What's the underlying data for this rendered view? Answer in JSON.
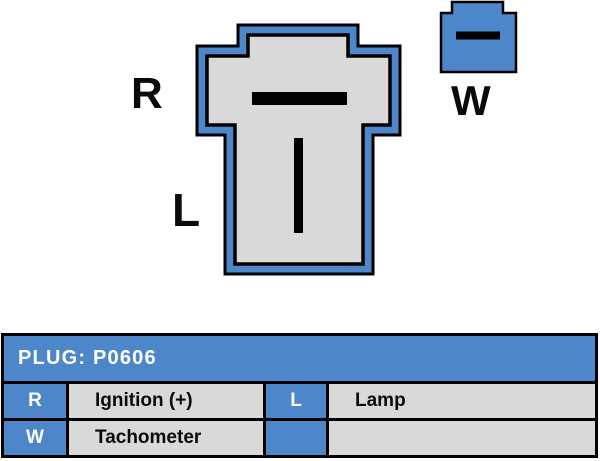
{
  "diagram": {
    "main_connector": {
      "terminal_r_label": "R",
      "terminal_l_label": "L"
    },
    "aux_connector": {
      "terminal_w_label": "W"
    },
    "colors": {
      "connector_blue": "#4d87c9",
      "connector_gray": "#d9d9d9",
      "outline_black": "#000000"
    }
  },
  "table": {
    "title": "PLUG: P0606",
    "header_bg": "#4d87c9",
    "rows": [
      {
        "key1": "R",
        "value1": "Ignition (+)",
        "key2": "L",
        "value2": "Lamp"
      },
      {
        "key1": "W",
        "value1": "Tachometer",
        "key2": "",
        "value2": ""
      }
    ]
  }
}
